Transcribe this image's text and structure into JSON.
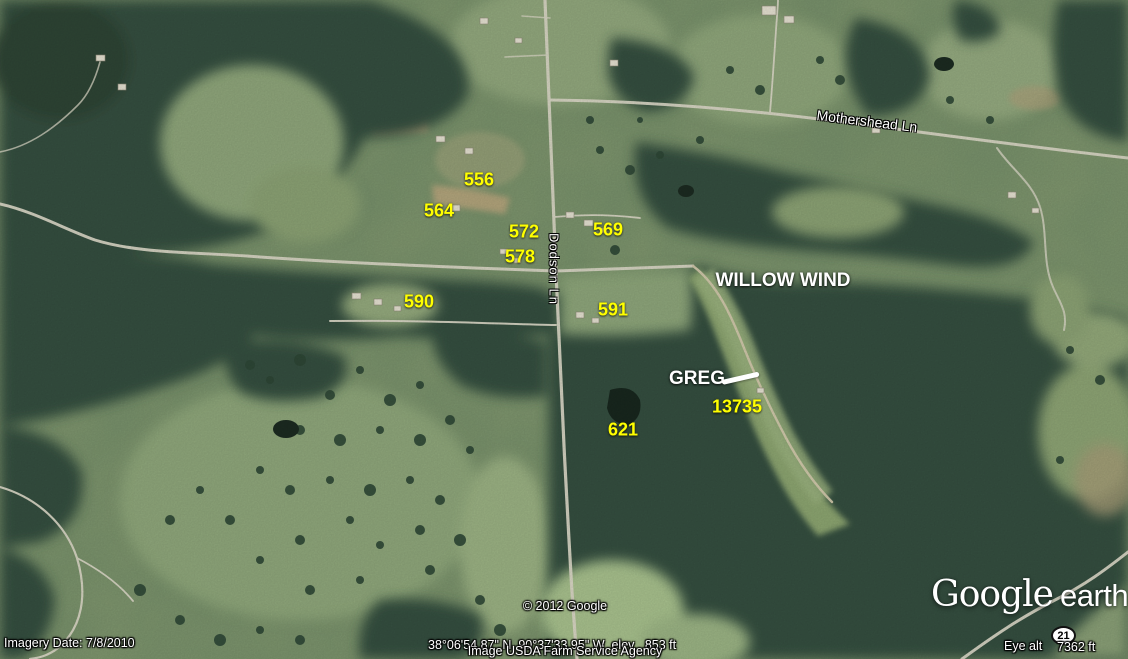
{
  "annotations": {
    "parcels": [
      {
        "label": "556"
      },
      {
        "label": "564"
      },
      {
        "label": "572"
      },
      {
        "label": "578"
      },
      {
        "label": "569"
      },
      {
        "label": "590"
      },
      {
        "label": "591"
      },
      {
        "label": "621"
      },
      {
        "label": "13735"
      }
    ],
    "places": [
      {
        "label": "WILLOW WIND"
      },
      {
        "label": "GREG"
      }
    ],
    "marker_badge": "21"
  },
  "road_labels": {
    "mothershead": "Mothershead Ln",
    "dodson": "Dodson Ln"
  },
  "status_bar": {
    "imagery_date": "Imagery Date: 7/8/2010",
    "coordinates": "38°06'54.87\" N  90°37'33.95\" W  elev   853 ft",
    "eye_alt_label": "Eye alt",
    "eye_alt_value": "7362 ft"
  },
  "attribution": {
    "copyright": "© 2012 Google",
    "source": "Image USDA Farm Service Agency"
  },
  "logo": {
    "brand": "Google",
    "product": "earth"
  },
  "colors": {
    "parcel_label": "#ffff00",
    "place_label": "#ffffff",
    "annotation_line": "#ffffff",
    "forest": "#36503f",
    "field": "#8aa077",
    "road": "#dbd8c7"
  }
}
